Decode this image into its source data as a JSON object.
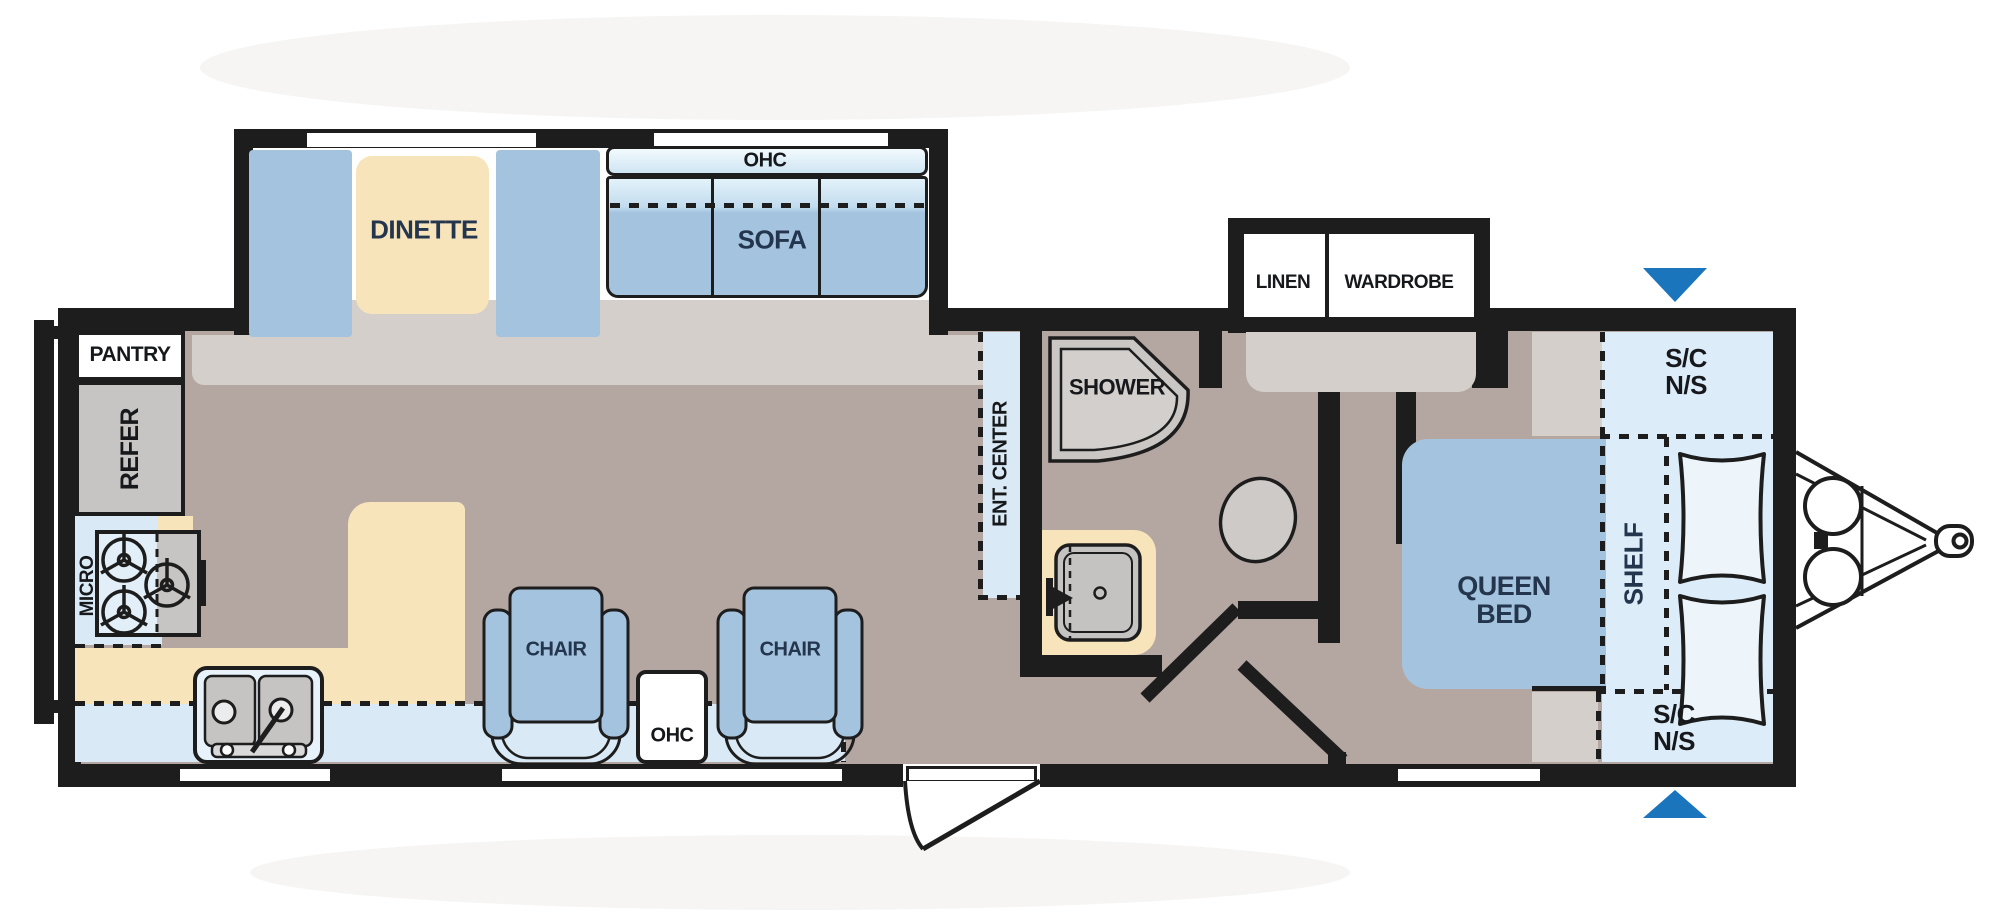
{
  "title": "Travel trailer floor plan",
  "colors": {
    "wall": "#1d1d1d",
    "floor_taupe": "#b4a6a1",
    "furniture_blue": "#a4c3df",
    "cabinet_light_blue": "#d9eaf6",
    "counter_cream": "#f8e4ba",
    "appliance_gray": "#c7c5c3",
    "landing_gray": "#d4cfca",
    "arrow_blue": "#1b75bc",
    "label_navy": "#24364e"
  },
  "front_slideout": {
    "ohc": "OHC",
    "dinette": "DINETTE",
    "sofa": "SOFA"
  },
  "kitchen": {
    "pantry": "PANTRY",
    "refer": "REFER",
    "micro": "MICRO"
  },
  "living": {
    "chair_left": "CHAIR",
    "chair_right": "CHAIR",
    "ohc": "OHC",
    "ent_center": "ENT. CENTER"
  },
  "bath": {
    "shower": "SHOWER"
  },
  "bedroom_slideout": {
    "linen": "LINEN",
    "wardrobe": "WARDROBE"
  },
  "bedroom": {
    "queen_bed": {
      "line1": "QUEEN",
      "line2": "BED"
    },
    "shelf": "SHELF",
    "sc_ns_top": {
      "line1": "S/C",
      "line2": "N/S"
    },
    "sc_ns_bottom": {
      "line1": "S/C",
      "line2": "N/S"
    }
  }
}
